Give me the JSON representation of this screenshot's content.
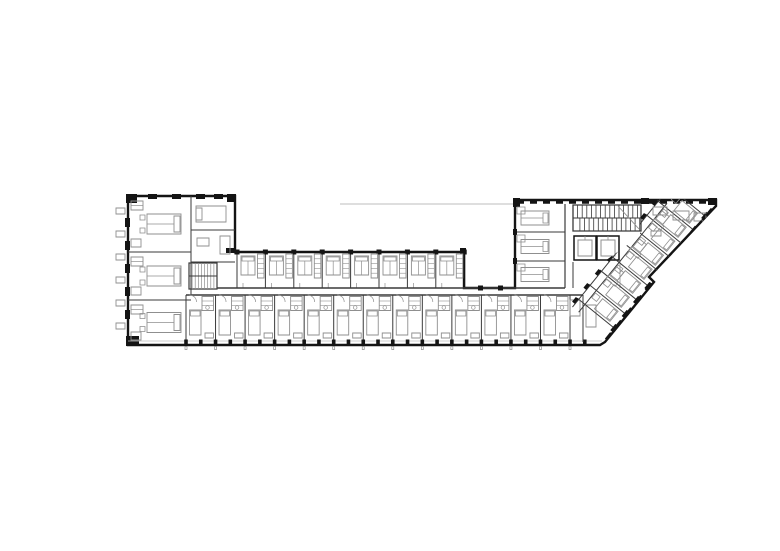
{
  "meta": {
    "drawing_type": "architectural-floor-plan",
    "subject": "hotel floor plan, elongated bar with left wing, service core and 45-degree angled right wing",
    "visible_text": []
  },
  "canvas": {
    "width": 780,
    "height": 551,
    "background": "#ffffff"
  },
  "colors": {
    "wall": "#141414",
    "partition": "#3a3a3a",
    "furniture": "#8f8f8f",
    "light": "#bdbdbd"
  },
  "outline": {
    "points": [
      [
        128,
        196
      ],
      [
        235,
        196
      ],
      [
        235,
        252
      ],
      [
        464,
        252
      ],
      [
        464,
        288
      ],
      [
        515,
        288
      ],
      [
        515,
        200
      ],
      [
        716,
        200
      ],
      [
        716,
        206
      ],
      [
        649,
        277
      ],
      [
        654,
        282
      ],
      [
        605,
        342
      ],
      [
        600,
        345
      ],
      [
        128,
        345
      ]
    ]
  },
  "canopy_line": {
    "x1": 340,
    "y1": 204,
    "x2": 515,
    "y2": 204
  },
  "corner_blocks": [
    [
      126,
      194,
      11,
      9
    ],
    [
      227,
      194,
      9,
      8
    ],
    [
      513,
      198,
      7,
      9
    ],
    [
      641,
      198,
      8,
      6
    ],
    [
      708,
      198,
      9,
      7
    ],
    [
      126,
      336,
      13,
      10
    ],
    [
      226,
      248,
      10,
      5
    ],
    [
      460,
      248,
      6,
      6
    ]
  ],
  "west_facade": {
    "ticks": {
      "x": 116,
      "w": 9,
      "h": 6,
      "ys": [
        208,
        231,
        254,
        277,
        300,
        323
      ]
    },
    "piers": {
      "x": 125,
      "w": 5,
      "h": 9,
      "ys": [
        218,
        241,
        264,
        287,
        310
      ]
    }
  },
  "north_piers_left_wing": {
    "y": 194,
    "w": 9,
    "h": 5,
    "xs": [
      148,
      172,
      196,
      214
    ]
  },
  "left_wing": {
    "x0": 128,
    "x1": 235,
    "partition_x": 191,
    "west_units": [
      {
        "y0": 196,
        "y1": 252
      },
      {
        "y0": 252,
        "y1": 300
      },
      {
        "y0": 300,
        "y1": 345
      }
    ],
    "east_partition_ys": [
      230,
      262
    ],
    "stair": {
      "x": 189,
      "y": 263,
      "w": 28,
      "h": 26,
      "treads": 9
    }
  },
  "middle_row": {
    "x0": 237,
    "pitch": 28.4,
    "count": 8,
    "top": 252,
    "bottom": 288,
    "end_wall_x": 464
  },
  "corridor": {
    "top_y": 288,
    "top_x1": 217,
    "top_x2": 565,
    "bottom_y": 295,
    "bottom_x1": 186,
    "bottom_x2": 583,
    "upper_wall_piers_x": [
      478,
      498
    ]
  },
  "bottom_row": {
    "x0": 186,
    "pitch": 29.54,
    "count": 13,
    "top": 295,
    "bottom": 342,
    "sill_y": 341,
    "pier_y": 339.5,
    "tick_y": 346.5,
    "junction_partition_x": 583
  },
  "core": {
    "x0": 515,
    "x1": 648,
    "top": 200,
    "bottom": 290,
    "inner_wall_x": 565,
    "west_partition_ys": [
      232,
      261
    ],
    "west_units": [
      {
        "y0": 204,
        "y1": 232
      },
      {
        "y0": 232,
        "y1": 261
      },
      {
        "y0": 261,
        "y1": 288
      }
    ],
    "stair": {
      "x": 573,
      "y": 205,
      "w": 68,
      "h": 26,
      "tread_step": 4.6
    },
    "elevators": [
      {
        "x": 574,
        "y": 236,
        "w": 22,
        "h": 24
      },
      {
        "x": 597,
        "y": 236,
        "w": 22,
        "h": 24
      }
    ],
    "north_dash": {
      "y": 202,
      "x1": 517,
      "x2": 713,
      "dash": "7 6",
      "width": 3.5
    }
  },
  "angled_wing": {
    "origin": [
      713,
      207
    ],
    "dir": [
      -0.631,
      0.778
    ],
    "perp": [
      -0.778,
      -0.631
    ],
    "angle_deg": 129,
    "length": 170,
    "party_wall_ks": [
      12,
      30,
      48,
      66,
      84,
      102,
      120,
      138,
      156
    ],
    "wall_depth": 48,
    "corridor_offsets": [
      38,
      46
    ],
    "nw_texture_ks": [
      40,
      76,
      112
    ],
    "edge_dash": "9 7",
    "clip": [
      [
        640,
        199
      ],
      [
        717,
        199
      ],
      [
        717,
        206
      ],
      [
        650,
        278
      ],
      [
        655,
        283
      ],
      [
        606,
        343
      ],
      [
        598,
        346
      ],
      [
        560,
        346
      ],
      [
        560,
        293
      ],
      [
        640,
        236
      ]
    ],
    "ne_strip_furniture": [
      [
        653,
        207,
        14,
        8
      ],
      [
        673,
        211,
        16,
        9
      ],
      [
        694,
        213,
        12,
        8
      ],
      [
        651,
        231,
        10,
        5
      ]
    ]
  }
}
